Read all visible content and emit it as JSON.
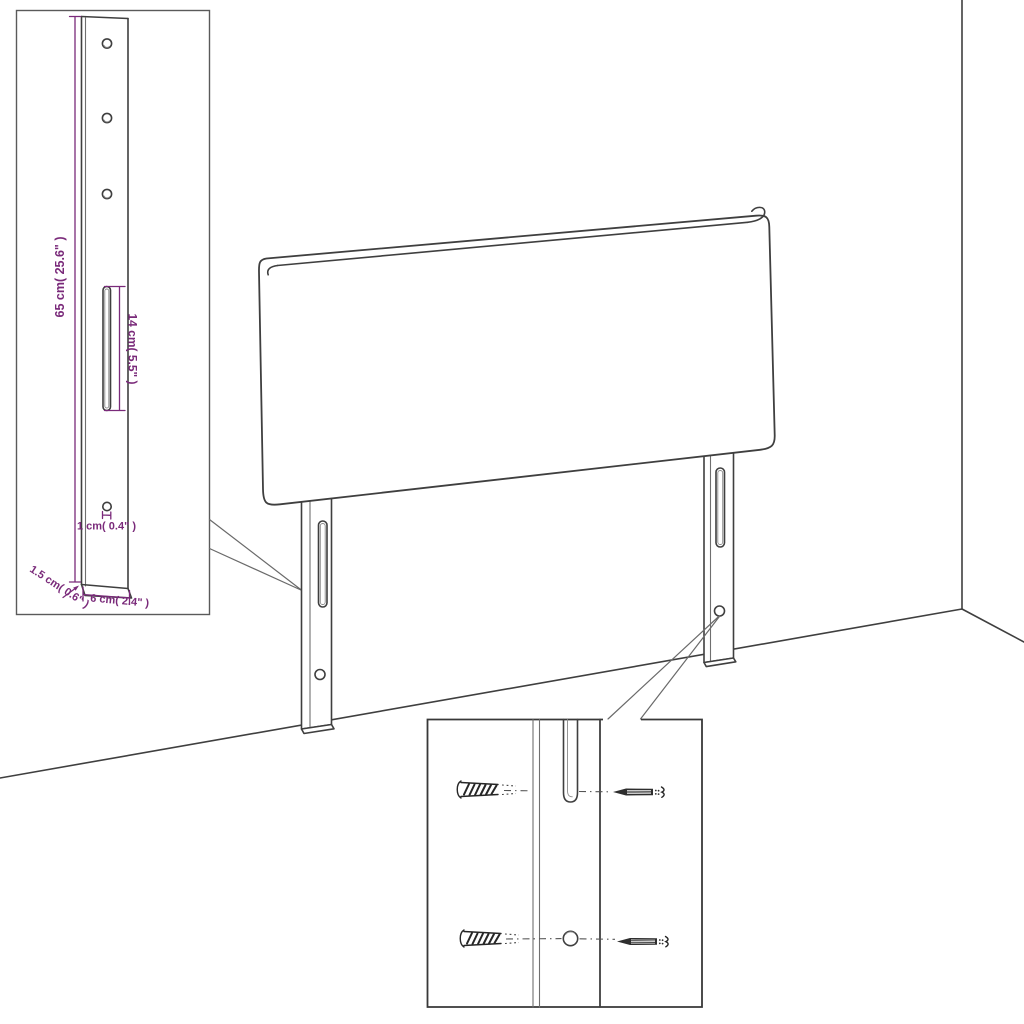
{
  "page": {
    "type": "product-assembly-diagram",
    "subject": "Upholstered headboard with two slotted mounting legs shown in a room corner, with a leg-dimension inset and a wall-mounting hardware inset",
    "background": "#ffffff"
  },
  "colors": {
    "outline": "#3f3f3f",
    "dimension_text": "#7a2a7a"
  },
  "leg_dimension_inset": {
    "height_label": "65 cm( 25.6\" )",
    "slot_length_label": "14 cm( 5.5\" )",
    "hole_diameter_label": "1 cm( 0.4\" )",
    "thickness_label": "1.5 cm( 0.6\" )",
    "width_label": "6 cm( 2.4\" )",
    "hole_count": 4,
    "slot_count": 1
  },
  "mounting_inset": {
    "wall_plug_count": 2,
    "screw_count": 2
  },
  "headboard": {
    "leg_count": 2
  }
}
